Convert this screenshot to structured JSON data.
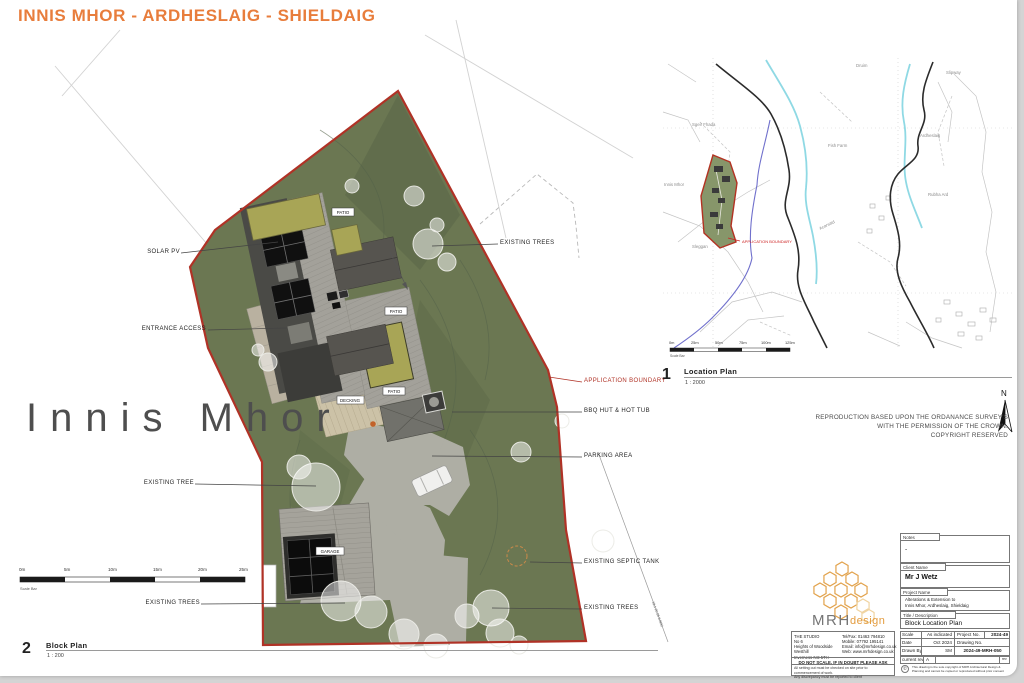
{
  "header": {
    "title": "INNIS MHOR - ARDHESLAIG - SHIELDAIG"
  },
  "site_label": "Innis  Mhor",
  "block_plan": {
    "number": "2",
    "name": "Block Plan",
    "scale": "1 : 200",
    "scale_bar_caption": "Scale Bar",
    "scale_bar_labels": [
      "0m",
      "5m",
      "10m",
      "15m",
      "20m",
      "25m"
    ],
    "callouts": {
      "solar_pv": "SOLAR PV",
      "entrance_access": "ENTRANCE ACCESS",
      "existing_tree": "EXISTING TREE",
      "existing_trees_sw": "EXISTING TREES",
      "existing_trees_ne": "EXISTING TREES",
      "application_boundary": "APPLICATION BOUNDARY",
      "bbq_hut": "BBQ HUT & HOT TUB",
      "parking_area": "PARKING AREA",
      "septic_tank": "EXISTING SEPTIC TANK",
      "existing_trees_se": "EXISTING TREES"
    },
    "plan_tags": {
      "patio1": "PATIO",
      "patio2": "PATIO",
      "patio3": "PATIO",
      "decking": "DECKING",
      "garage": "GARAGE"
    },
    "road_ref": "19.1 20 26 9 BRC"
  },
  "location_plan": {
    "number": "1",
    "name": "Location Plan",
    "scale": "1 : 2000",
    "scale_bar_caption": "Scale Bar",
    "scale_bar_labels": [
      "0m",
      "25m",
      "50m",
      "75m",
      "100m",
      "125m"
    ],
    "boundary_label": "APPLICATION BOUNDARY",
    "north": "N",
    "map_labels": {
      "sgeir": "Sgeir Fhada",
      "druim": "Druim",
      "slipway": "Slipway",
      "fish_farm": "Fish Farm",
      "ardheslaig": "Ardheslaig",
      "innis_mhor": "Innis Mhor",
      "acarsaid": "Acarsaid",
      "sleggan": "Sleggan",
      "rubha": "Rubha Ard"
    }
  },
  "os_note": {
    "line1": "REPRODUCTION BASED UPON THE ORDANANCE SURVEY'S",
    "line2": "WITH THE PERMISSION OF THE CROWN.",
    "line3": "COPYRIGHT RESERVED"
  },
  "title_block": {
    "logo_text_1": "MRH",
    "logo_text_2": "design",
    "address_lines": [
      "THE STUDIO",
      "No 6",
      "Heights of Woodside",
      "Westhill",
      "Inverness IV2 5TH"
    ],
    "contact_lines": [
      "Tel/Fax: 01463 794810",
      "Mobile: 07792 195141",
      "Email: info@mrhdesign.co.uk",
      "Web: www.mrhdesign.co.uk"
    ],
    "do_not_scale": "DO NOT SCALE. IF IN DOUBT PLEASE ASK",
    "disclaimer_1": "All setting out must be checked on site prior to commencement of work.",
    "disclaimer_2": "Any discrepancy must be reported to client",
    "notes_label": "Notes",
    "notes_value": "-",
    "client_label": "Client Name",
    "client_value": "Mr J Wetz",
    "project_label": "Project Name",
    "project_line_1": "Alterations & Extension to",
    "project_line_2": "Innis Mhor, Ardheslaig, Shieldaig",
    "title_label": "Title / Description",
    "title_value": "Block Location Plan",
    "scale_label": "Scale",
    "scale_value": "As indicated",
    "date_label": "Date",
    "date_value": "Oct 2024",
    "drawn_label": "Drawn By",
    "drawn_value": "SM",
    "project_no_label": "Project No.",
    "project_no_value": "2024-49",
    "drawing_no_label": "Drawing No.",
    "drawing_no_value": "2024-49-MRH-050",
    "rev_label": "current rev",
    "rev_value": "A",
    "rev_cell_label": "rev",
    "copyright_icon": "©",
    "copyright_1": "This drawing is the sole copyright of MRH Architectural Design &",
    "copyright_2": "Planning and cannot be copied or reproduced without prior consent"
  },
  "colors": {
    "accent_orange": "#e87d3c",
    "boundary_red": "#b03226",
    "site_green": "#6b7752",
    "logo_orange": "#e2a24b"
  }
}
